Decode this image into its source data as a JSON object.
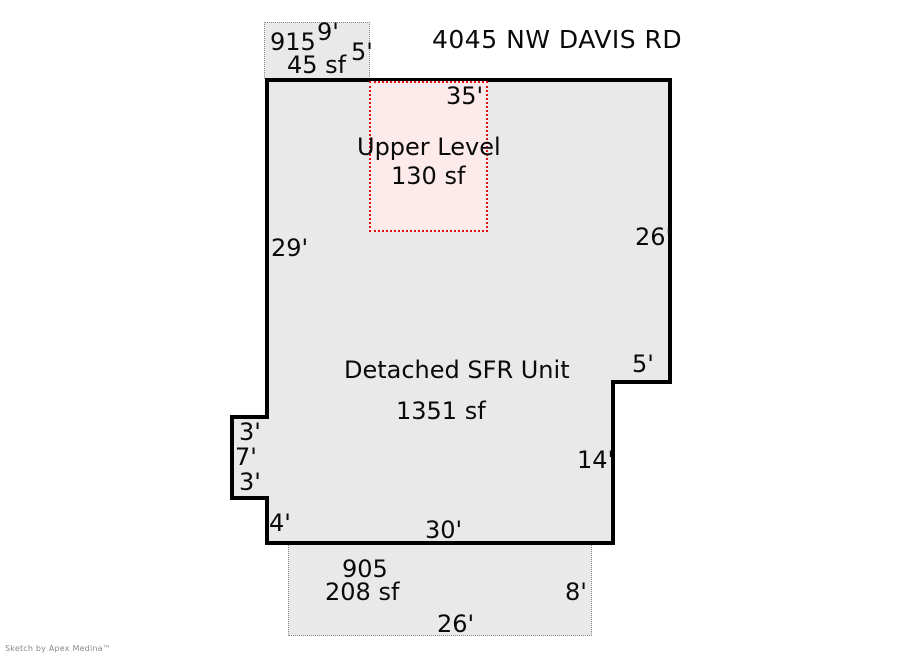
{
  "title": "4045 NW DAVIS RD",
  "watermark": "Sketch by Apex Medina™",
  "structures": {
    "unit_915": {
      "id": "915",
      "area": "45 sf",
      "width_ft": "9'",
      "depth_ft": "5'"
    },
    "upper_level": {
      "name": "Upper Level",
      "area": "130 sf"
    },
    "main_unit": {
      "name": "Detached SFR Unit",
      "area": "1351 sf",
      "dims": {
        "top": "35'",
        "left": "29'",
        "right_upper": "26'",
        "step_right": "5'",
        "right_lower": "14'",
        "bottom": "30'",
        "notch_upper": "3'",
        "notch_left": "7'",
        "notch_lower": "3'",
        "bottom_left": "4'"
      }
    },
    "unit_905": {
      "id": "905",
      "area": "208 sf",
      "width_ft": "26'",
      "depth_ft": "8'"
    }
  },
  "colors": {
    "floor_fill": "#e9e9e9",
    "wall": "#000000",
    "upper_level_fill": "#fdeaea",
    "upper_level_border": "#dd1111",
    "dotted_border": "#8a8a8a",
    "background": "#ffffff"
  }
}
